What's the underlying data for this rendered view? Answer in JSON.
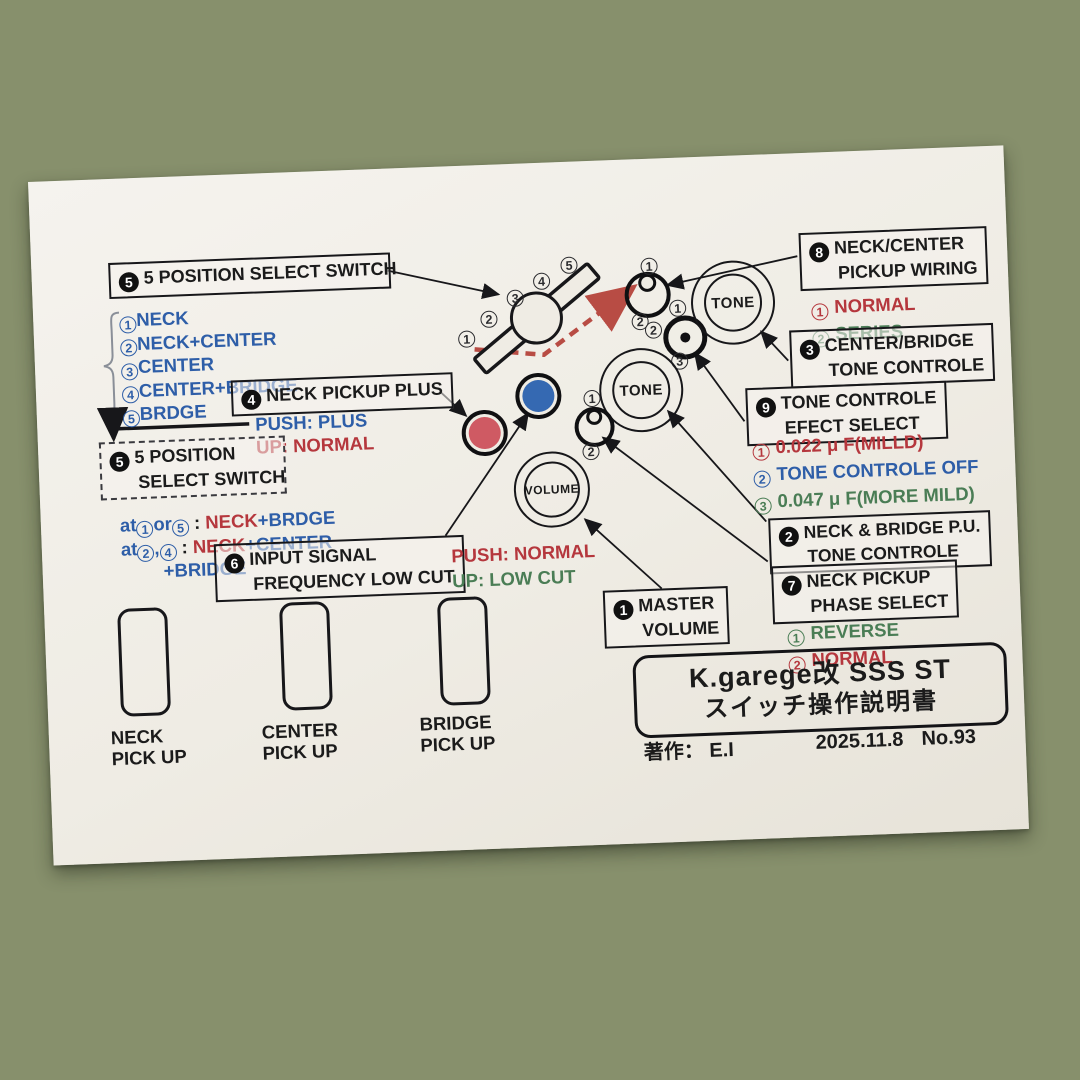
{
  "palette": {
    "red": "#b5373d",
    "blue": "#2e5ea8",
    "green": "#4a7d55",
    "ink": "#1b1b1b",
    "button_red": "#cf5a63",
    "button_blue": "#3569b2",
    "dashed_arrow_red": "#b84c44",
    "paper": "#efece4",
    "carpet_green": "#87906c",
    "carpet_cream": "#e0d2ad",
    "carpet_rust": "#bd7a4c"
  },
  "paper": {
    "box5top": {
      "num": "5",
      "title": "5 POSITION SELECT SWITCH"
    },
    "pos_list": {
      "items": [
        {
          "num": "1",
          "label": "NECK"
        },
        {
          "num": "2",
          "label": "NECK+CENTER"
        },
        {
          "num": "3",
          "label": "CENTER"
        },
        {
          "num": "4",
          "label": "CENTER+BRIDGE"
        },
        {
          "num": "5",
          "label": "BRDGE"
        }
      ]
    },
    "box4": {
      "num": "4",
      "title": "NECK PICKUP PLUS",
      "push": "PUSH: PLUS",
      "up": "UP:  NORMAL"
    },
    "box5side": {
      "num": "5",
      "line1": "5 POSITION",
      "line2": "SELECT SWITCH",
      "note1": {
        "pre": "at",
        "n1": "1",
        "mid": "or",
        "n2": "5",
        "sep": " : ",
        "red": "NECK",
        "blue": "+BRDGE"
      },
      "note2": {
        "pre": "at",
        "n1": "2",
        "mid": ",",
        "n2": "4",
        "sep": " : ",
        "red": "NECK",
        "blue": "+CENTER"
      },
      "note3": "+BRIDGE"
    },
    "box6": {
      "num": "6",
      "line1": "INPUT SIGNAL",
      "line2": "FREQUENCY LOW CUT",
      "push": "PUSH: NORMAL",
      "up": "UP:  LOW CUT"
    },
    "box8": {
      "num": "8",
      "line1": "NECK/CENTER",
      "line2": "PICKUP  WIRING",
      "options": [
        {
          "num": "1",
          "label": "NORMAL"
        },
        {
          "num": "2",
          "label": "SERIES"
        }
      ]
    },
    "box3": {
      "num": "3",
      "line1": "CENTER/BRIDGE",
      "line2": "TONE CONTROLE"
    },
    "box9": {
      "num": "9",
      "line1": "TONE CONTROLE",
      "line2": "EFECT  SELECT",
      "options": [
        {
          "num": "1",
          "label": "0.022 μ F(MILLD)"
        },
        {
          "num": "2",
          "label": "TONE CONTROLE OFF"
        },
        {
          "num": "3",
          "label": "0.047 μ F(MORE MILD)"
        }
      ]
    },
    "box2": {
      "num": "2",
      "line1": "NECK & BRIDGE P.U.",
      "line2": "TONE CONTROLE"
    },
    "box7": {
      "num": "7",
      "line1": "NECK PICKUP",
      "line2": "PHASE  SELECT",
      "options": [
        {
          "num": "1",
          "label": "REVERSE"
        },
        {
          "num": "2",
          "label": "NORMAL"
        }
      ]
    },
    "box1": {
      "num": "1",
      "line1": "MASTER",
      "line2": "VOLUME"
    },
    "knobs": {
      "tone_right": "TONE",
      "tone_left": "TONE",
      "volume": "VOLUME"
    },
    "lever_labels": {
      "n1": "1",
      "n2": "2",
      "n3": "3",
      "n4": "4",
      "n5": "5"
    },
    "toggle1_labels": {
      "n1": "1",
      "n2": "2"
    },
    "donut_labels": {
      "n1": "1",
      "n2": "2",
      "n3": "3"
    },
    "toggle2_labels": {
      "n1": "1",
      "n2": "2"
    },
    "pickups": {
      "neck": {
        "line1": "NECK",
        "line2": "PICK UP"
      },
      "center": {
        "line1": "CENTER",
        "line2": "PICK UP"
      },
      "bridge": {
        "line1": "BRIDGE",
        "line2": "PICK UP"
      }
    },
    "title_box": {
      "line1": "K.garege改  SSS  ST",
      "line2": "スイッチ操作説明書"
    },
    "footer": {
      "author": "著作：  E.I",
      "date": "2025.11.8",
      "number": "No.93"
    }
  }
}
